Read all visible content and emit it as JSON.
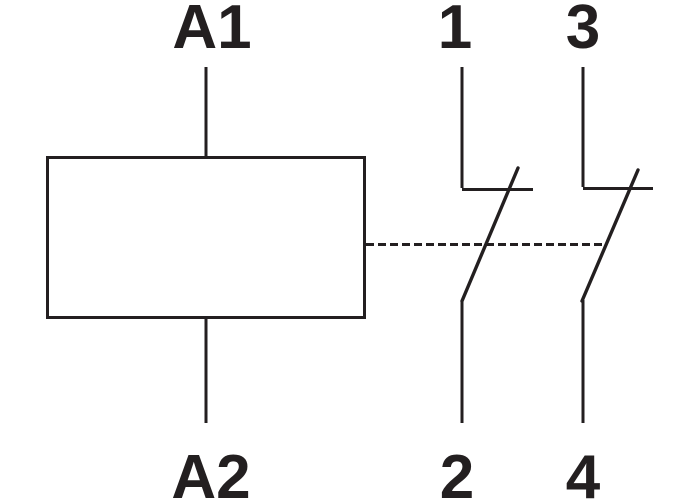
{
  "diagram": {
    "kind": "contactor-relay-schematic",
    "colors": {
      "line": "#231f20",
      "background": "#ffffff"
    },
    "coil": {
      "top_terminal": "A1",
      "bottom_terminal": "A2"
    },
    "contacts": [
      {
        "top_terminal": "1",
        "bottom_terminal": "2"
      },
      {
        "top_terminal": "3",
        "bottom_terminal": "4"
      }
    ]
  }
}
